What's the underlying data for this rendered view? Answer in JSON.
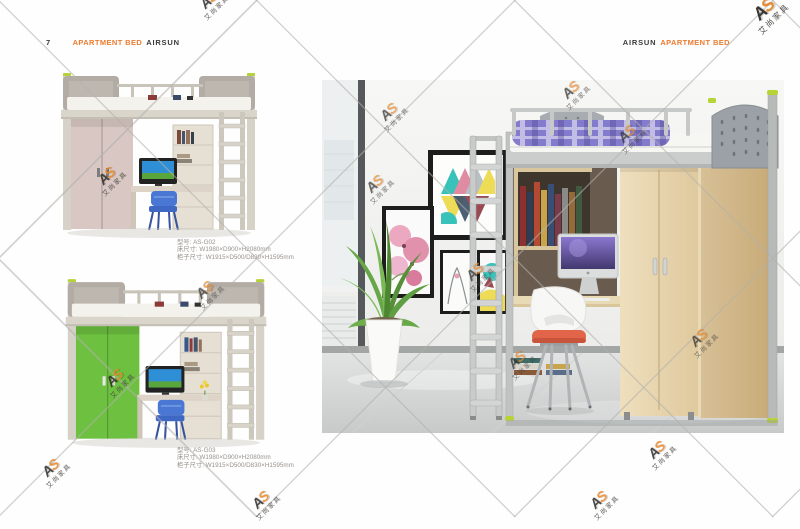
{
  "page": {
    "page_number": "7",
    "header_left": {
      "category": "APARTMENT BED",
      "brand": "AIRSUN"
    },
    "header_right": {
      "brand": "AIRSUN",
      "category": "APARTMENT BED"
    }
  },
  "watermark": {
    "letter_a": "A",
    "letter_s": "S",
    "company": "艾尚家具"
  },
  "products": [
    {
      "model": "型号: AS-G02",
      "bed_size": "床尺寸: W1980×D900×H2080mm",
      "cabinet_size": "柜子尺寸: W1915×D500/D830×H1595mm",
      "wardrobe_color": "#d8c7c2"
    },
    {
      "model": "型号: AS-G03",
      "bed_size": "床尺寸: W1980×D900×H2080mm",
      "cabinet_size": "柜子尺寸: W1915×D500/D830×H1595mm",
      "wardrobe_color": "#6ec041"
    }
  ],
  "colors": {
    "accent_orange": "#ed7b2f",
    "header_text": "#3a3a3a",
    "caption_text": "#97918c",
    "watermark_orange": "#e8882a",
    "bed_frame_gray": "#b7bab9",
    "lime_accent": "#b6d438",
    "bedding_purple": "#837bcb",
    "wood_maple": "#e8d8b4",
    "chair_blue": "#4a77d4",
    "chair_cushion_orange": "#e2654a"
  }
}
